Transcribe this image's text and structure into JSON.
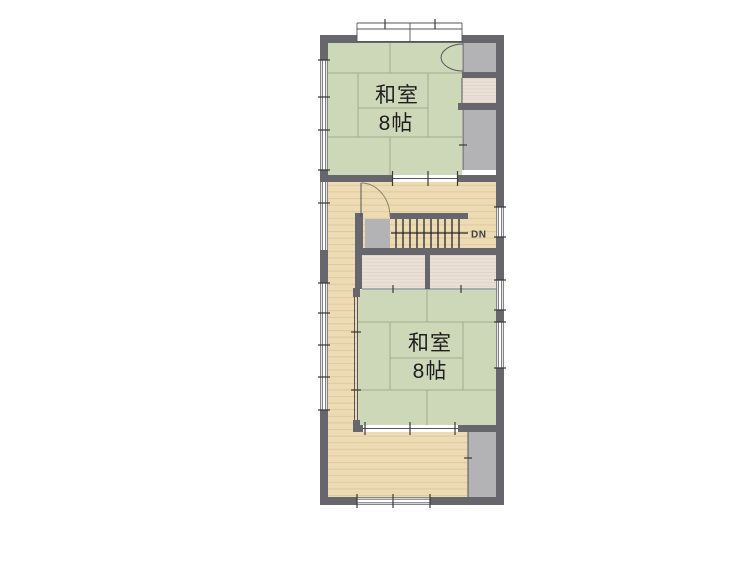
{
  "plan": {
    "title": "2F floor plan",
    "rooms": [
      {
        "name": "和室",
        "size": "8帖"
      },
      {
        "name": "和室",
        "size": "8帖"
      }
    ],
    "stairs": {
      "direction_label": "DN"
    },
    "colors": {
      "tatami": "#cdd8b9",
      "tatami_line": "#a4ad8c",
      "wood": "#eddbb4",
      "wood_line": "#dfc99f",
      "closet_wood": "#eae0d5",
      "closet_wood_line": "#dcd1c3",
      "gray": "#b3b3b6",
      "wall": "#66666c",
      "background": "#ffffff"
    }
  }
}
